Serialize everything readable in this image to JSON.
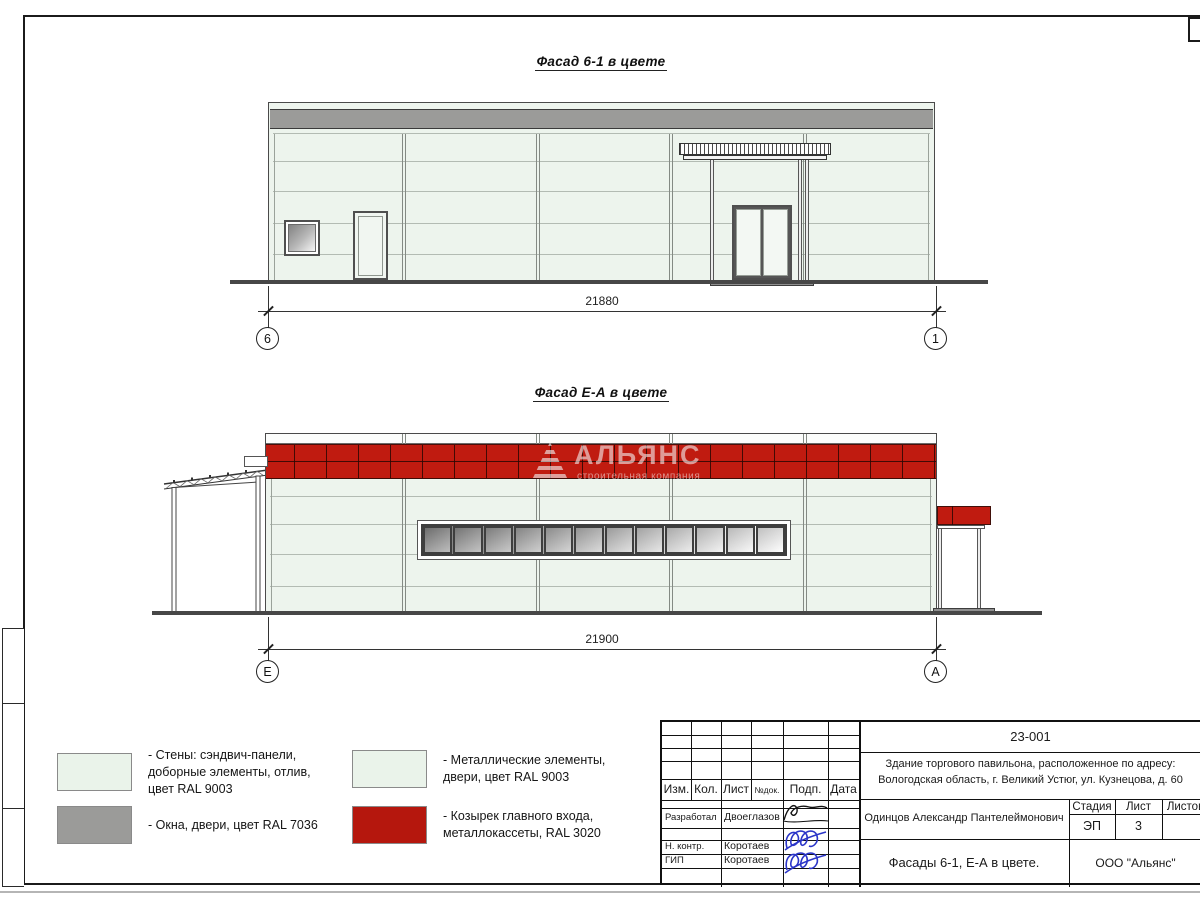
{
  "facades": {
    "f1": {
      "title": "Фасад 6-1 в цвете",
      "dimension": "21880",
      "axis_left": "6",
      "axis_right": "1"
    },
    "f2": {
      "title": "Фасад Е-А в цвете",
      "dimension": "21900",
      "axis_left": "Е",
      "axis_right": "А",
      "watermark_title": "АЛЬЯНС",
      "watermark_subtitle": "строительная компания",
      "window_pane_count": 12
    }
  },
  "legend": {
    "items": [
      {
        "color": "#eaf3ea",
        "label": "- Стены: сэндвич-панели,\nдоборные элементы, отлив,\nцвет RAL 9003"
      },
      {
        "color": "#9b9b99",
        "label": "- Окна, двери, цвет RAL 7036"
      },
      {
        "color": "#eaf3ea",
        "label": "- Металлические элементы,\nдвери, цвет RAL 9003"
      },
      {
        "color": "#b5170d",
        "label": "- Козырек главного входа,\nметаллокассеты, RAL 3020"
      }
    ]
  },
  "titleblock": {
    "doc_number": "23-001",
    "project_line1": "Здание торгового павильона, расположенное по адресу:",
    "project_line2": "Вологодская область, г. Великий Устюг, ул. Кузнецова, д. 60",
    "cols": {
      "izm": "Изм.",
      "kol": "Кол.",
      "list": "Лист",
      "ndok": "№док.",
      "podp": "Подп.",
      "data": "Дата"
    },
    "rows": [
      {
        "role": "Разработал",
        "name": "Двоеглазов"
      },
      {
        "role": "Н. контр.",
        "name": "Коротаев"
      },
      {
        "role": "ГИП",
        "name": "Коротаев"
      }
    ],
    "client": "Одинцов Александр Пантелеймонович",
    "stage_label": "Стадия",
    "stage_value": "ЭП",
    "sheet_label": "Лист",
    "sheet_value": "3",
    "sheets_label": "Листов",
    "drawing_title": "Фасады 6-1, Е-А в цвете.",
    "company": "ООО \"Альянс\""
  },
  "colors": {
    "wall": "#edf4ed",
    "metal_gray": "#9b9b99",
    "red": "#c01b10",
    "ground": "#474747"
  }
}
